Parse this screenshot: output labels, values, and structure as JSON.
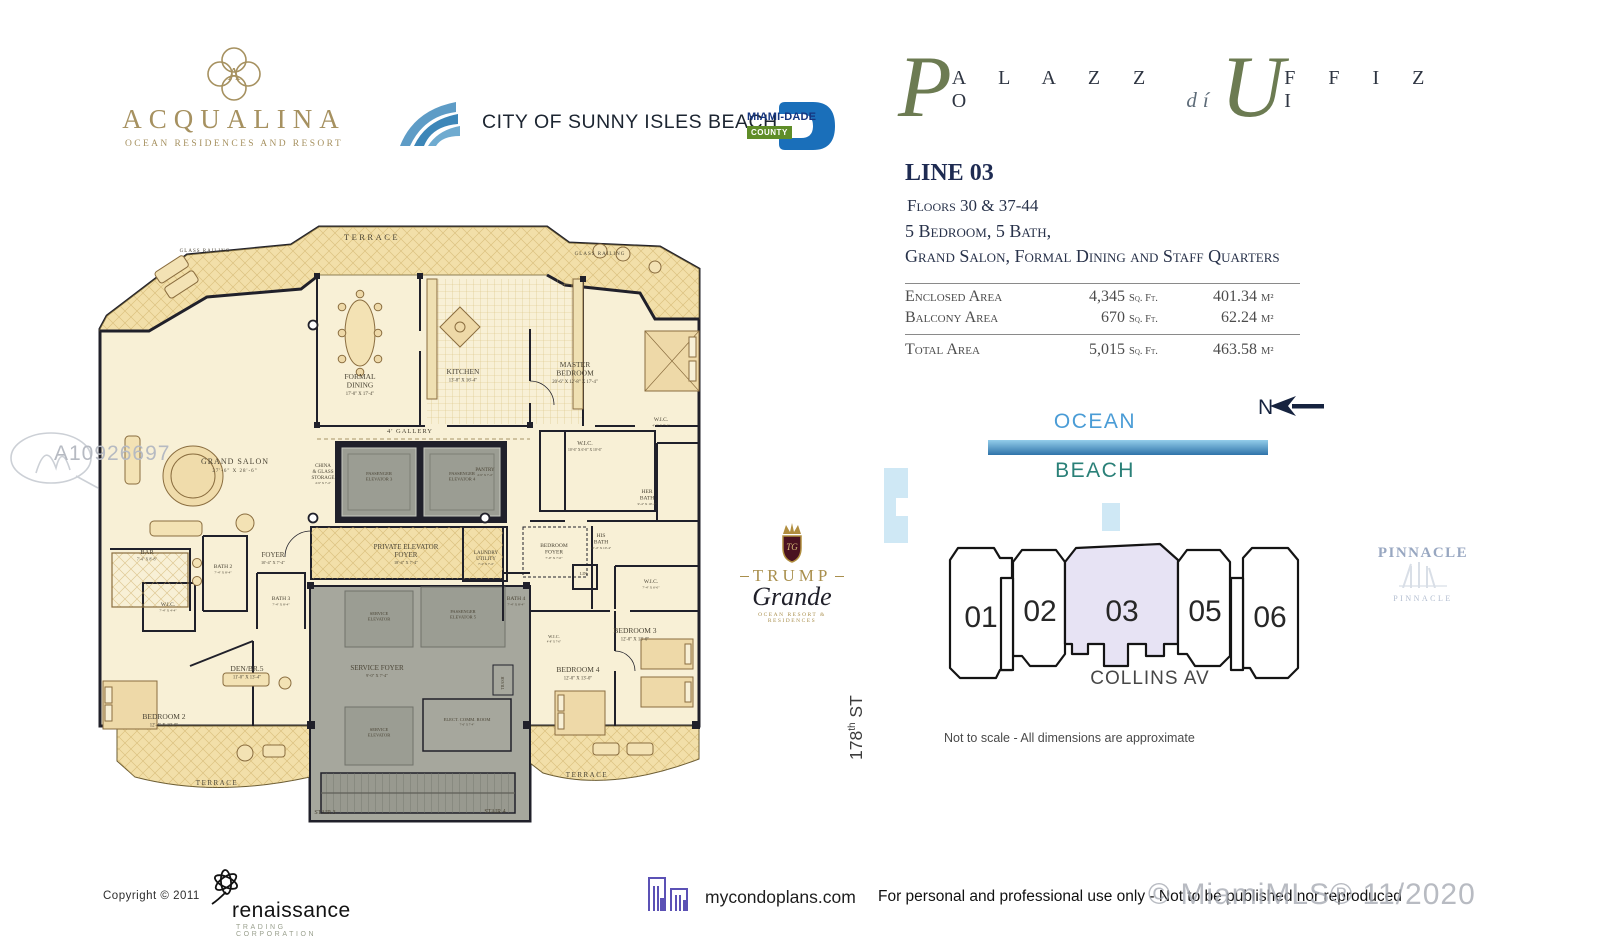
{
  "colors": {
    "accent_olive": "#6c7b52",
    "navy": "#1e2b52",
    "gold": "#a69160",
    "ocean_blue": "#4a9cd6",
    "beach_teal": "#2a8078",
    "highlight_lavender": "#e7e3f4",
    "plan_cream": "#f8f0d6",
    "terrace_tan": "#f2dfa9",
    "core_gray": "#a6a79d"
  },
  "header": {
    "acqualina": {
      "name": "ACQUALINA",
      "tagline": "OCEAN RESIDENCES AND RESORT"
    },
    "sunny_isles": {
      "name": "CITY OF SUNNY ISLES BEACH"
    },
    "miami_dade": {
      "name": "MIAMI-DADE",
      "county": "COUNTY"
    },
    "palazzo": {
      "p": "P",
      "alazzo": "A L A Z Z O",
      "di": "dí",
      "u": "U",
      "ffizi": "F F I Z I"
    }
  },
  "unit": {
    "line": "LINE 03",
    "floors": "Floors 30 & 37-44",
    "config": "5 Bedroom, 5 Bath,",
    "features": "Grand Salon, Formal Dining and Staff Quarters",
    "areas": [
      {
        "label": "Enclosed Area",
        "sqft": "4,345",
        "sqft_unit": "Sq. Ft.",
        "m2": "401.34",
        "m2_unit": "M²"
      },
      {
        "label": "Balcony Area",
        "sqft": "670",
        "sqft_unit": "Sq. Ft.",
        "m2": "62.24",
        "m2_unit": "M²"
      },
      {
        "label": "Total Area",
        "sqft": "5,015",
        "sqft_unit": "Sq. Ft.",
        "m2": "463.58",
        "m2_unit": "M²"
      }
    ]
  },
  "site": {
    "north": "N",
    "ocean": "OCEAN",
    "beach": "BEACH",
    "units": [
      "01",
      "02",
      "03",
      "05",
      "06"
    ],
    "highlighted_unit": "03",
    "highlight_color": "#e7e3f4",
    "street": "COLLINS AV",
    "cross_street": {
      "num": "178",
      "sup": "th",
      "rest": " ST"
    },
    "note": "Not to scale - All dimensions are approximate"
  },
  "logos": {
    "trump": {
      "name": "TRUMP",
      "script": "Grande",
      "tagline": "OCEAN RESORT & RESIDENCES"
    },
    "pinnacle": {
      "name": "PINNACLE",
      "name_small": "PINNACLE"
    },
    "renaissance": {
      "name": "renaissance",
      "tagline": "TRADING CORPORATION"
    },
    "mycondoplans": {
      "site": "mycondoplans.com"
    }
  },
  "footer": {
    "copyright": "Copyright  ©   2011",
    "disclaimer": "For personal and professional use only - Not to be published nor reproduced",
    "watermark": "© MiamiMLS® 11/2020",
    "mls_id": "A10926697"
  },
  "floorplan": {
    "labels": [
      {
        "id": "glass-railing-left",
        "x": 110,
        "y": 31,
        "t": [
          "GLASS RAILING"
        ],
        "s": 5,
        "ls": 1
      },
      {
        "id": "terrace-top",
        "x": 277,
        "y": 19,
        "t": [
          "TERRACE"
        ],
        "s": 8.5,
        "ls": 2.5
      },
      {
        "id": "glass-railing-right",
        "x": 505,
        "y": 34,
        "t": [
          "GLASS RAILING"
        ],
        "s": 5,
        "ls": 1
      },
      {
        "id": "formal-dining",
        "x": 265,
        "y": 158,
        "t": [
          "FORMAL",
          "DINING"
        ],
        "s": 7.5,
        "d": "17'-0\" X 17'-4\""
      },
      {
        "id": "kitchen",
        "x": 368,
        "y": 153,
        "t": [
          "KITCHEN"
        ],
        "s": 7.5,
        "d": "13'-8\" X 16'-4\""
      },
      {
        "id": "gallery",
        "x": 315,
        "y": 212,
        "t": [
          "4' GALLERY"
        ],
        "s": 6.5,
        "ls": 1
      },
      {
        "id": "master-bedroom",
        "x": 480,
        "y": 146,
        "t": [
          "MASTER",
          "BEDROOM"
        ],
        "s": 7.5,
        "d": "20'-6\" X 12'-8\" X 17'-4\""
      },
      {
        "id": "grand-salon",
        "x": 140,
        "y": 243,
        "t": [
          "GRAND SALON"
        ],
        "s": 8,
        "ls": 1,
        "d": "27'-6\" X 28'-6\""
      },
      {
        "id": "china-storage",
        "x": 228,
        "y": 246,
        "t": [
          "CHINA",
          "& GLASS",
          "STORAGE"
        ],
        "s": 5,
        "d": "4'-9\" X 7'-4\""
      },
      {
        "id": "pantry",
        "x": 390,
        "y": 250,
        "t": [
          "PANTRY"
        ],
        "s": 5,
        "d": "4'-9\" X 7'-4\""
      },
      {
        "id": "passenger-elevator-3",
        "x": 284,
        "y": 254,
        "t": [
          "PASSENGER",
          "ELEVATOR 3"
        ],
        "s": 4.6
      },
      {
        "id": "passenger-elevator-4",
        "x": 367,
        "y": 254,
        "t": [
          "PASSENGER",
          "ELEVATOR 4"
        ],
        "s": 4.6
      },
      {
        "id": "bar",
        "x": 52,
        "y": 333,
        "t": [
          "BAR"
        ],
        "s": 6.5,
        "d": "7'-4\" X 8'-8\""
      },
      {
        "id": "bath-2",
        "x": 128,
        "y": 347,
        "t": [
          "BATH 2"
        ],
        "s": 5.5,
        "d": "7'-4\" X 8'-4\""
      },
      {
        "id": "foyer",
        "x": 178,
        "y": 336,
        "t": [
          "FOYER"
        ],
        "s": 7,
        "d": "10'-4\" X 7'-4\""
      },
      {
        "id": "private-elevator-foyer",
        "x": 311,
        "y": 328,
        "t": [
          "PRIVATE ELEVATOR",
          "FOYER"
        ],
        "s": 7,
        "d": "18'-4\" X 7'-4\""
      },
      {
        "id": "laundry-utility",
        "x": 391,
        "y": 333,
        "t": [
          "LAUNDRY",
          "UTILITY"
        ],
        "s": 5,
        "d": "7'-4\" X 7'-4\""
      },
      {
        "id": "bedroom-foyer",
        "x": 459,
        "y": 326,
        "t": [
          "BEDROOM",
          "FOYER"
        ],
        "s": 5.5,
        "d": "7'-0\" X 7'-0\""
      },
      {
        "id": "her-bath",
        "x": 552,
        "y": 272,
        "t": [
          "HER",
          "BATH"
        ],
        "s": 5.5,
        "d": "9'-4\" X 10'-4\""
      },
      {
        "id": "his-bath",
        "x": 506,
        "y": 316,
        "t": [
          "HIS",
          "BATH"
        ],
        "s": 5.5,
        "d": "10'-4\" X 10'-4\""
      },
      {
        "id": "wic-master",
        "x": 490,
        "y": 224,
        "t": [
          "W.I.C."
        ],
        "s": 6,
        "d": "10'-6\" X 6'-0\" X 10'-6\""
      },
      {
        "id": "wic-top-right",
        "x": 566,
        "y": 200,
        "t": [
          "W.I.C."
        ],
        "s": 5.5,
        "d": "4'-0\" X 7'-4\""
      },
      {
        "id": "lin",
        "x": 489,
        "y": 354,
        "t": [
          "LIN."
        ],
        "s": 4.5
      },
      {
        "id": "wic-bed3",
        "x": 556,
        "y": 362,
        "t": [
          "W.I.C."
        ],
        "s": 5.5,
        "d": "7'-4\" X 6'-0\""
      },
      {
        "id": "bedroom-3",
        "x": 540,
        "y": 412,
        "t": [
          "BEDROOM 3"
        ],
        "s": 7.5,
        "d": "12'-0\" X 13'-0\""
      },
      {
        "id": "bath-4",
        "x": 421,
        "y": 379,
        "t": [
          "BATH 4"
        ],
        "s": 5.5,
        "d": "7'-4\" X 8'-4\""
      },
      {
        "id": "bath-3",
        "x": 186,
        "y": 379,
        "t": [
          "BATH 3"
        ],
        "s": 5.5,
        "d": "7'-4\" X 8'-4\""
      },
      {
        "id": "wic-left",
        "x": 73,
        "y": 385,
        "t": [
          "W.I.C."
        ],
        "s": 5.5,
        "d": "7'-4\" X 4'-4\""
      },
      {
        "id": "den-br5",
        "x": 152,
        "y": 450,
        "t": [
          "DEN/BR.5"
        ],
        "s": 7.5,
        "d": "11'-0\" X 13'-4\""
      },
      {
        "id": "bedroom-2",
        "x": 69,
        "y": 498,
        "t": [
          "BEDROOM 2"
        ],
        "s": 7.5,
        "d": "12'-4\" X 18'-0\""
      },
      {
        "id": "service-foyer",
        "x": 282,
        "y": 449,
        "t": [
          "SERVICE FOYER"
        ],
        "s": 7,
        "d": "9'-0\" X 7'-4\""
      },
      {
        "id": "service-elevator-upper",
        "x": 284,
        "y": 394,
        "t": [
          "SERVICE",
          "ELEVATOR"
        ],
        "s": 4.5
      },
      {
        "id": "passenger-elevator-5",
        "x": 368,
        "y": 392,
        "t": [
          "PASSENGER",
          "ELEVATOR 5"
        ],
        "s": 4.5
      },
      {
        "id": "service-elevator-lower",
        "x": 284,
        "y": 510,
        "t": [
          "SERVICE",
          "ELEVATOR"
        ],
        "s": 4.5
      },
      {
        "id": "elect-comm-room",
        "x": 372,
        "y": 500,
        "t": [
          "ELECT. COMM. ROOM"
        ],
        "s": 4.6,
        "d": "7'-6\" X 7'-4\""
      },
      {
        "id": "trash",
        "x": 409,
        "y": 462,
        "t": [
          "TRASH"
        ],
        "s": 4,
        "rot": -90
      },
      {
        "id": "stair-3",
        "x": 230,
        "y": 593,
        "t": [
          "STAIR 3"
        ],
        "s": 6
      },
      {
        "id": "stair-4",
        "x": 400,
        "y": 592,
        "t": [
          "STAIR 4"
        ],
        "s": 6
      },
      {
        "id": "terrace-bottom-left",
        "x": 122,
        "y": 564,
        "t": [
          "TERRACE"
        ],
        "s": 7,
        "ls": 1.5
      },
      {
        "id": "terrace-bottom-right",
        "x": 492,
        "y": 556,
        "t": [
          "TERRACE"
        ],
        "s": 7,
        "ls": 1.5
      },
      {
        "id": "bedroom-4",
        "x": 483,
        "y": 451,
        "t": [
          "BEDROOM 4"
        ],
        "s": 7.5,
        "d": "12'-0\" X 13'-0\""
      },
      {
        "id": "wic-bed4",
        "x": 459,
        "y": 417,
        "t": [
          "W.I.C."
        ],
        "s": 4.5,
        "d": "4'-8\" X 7'-0\""
      }
    ]
  }
}
